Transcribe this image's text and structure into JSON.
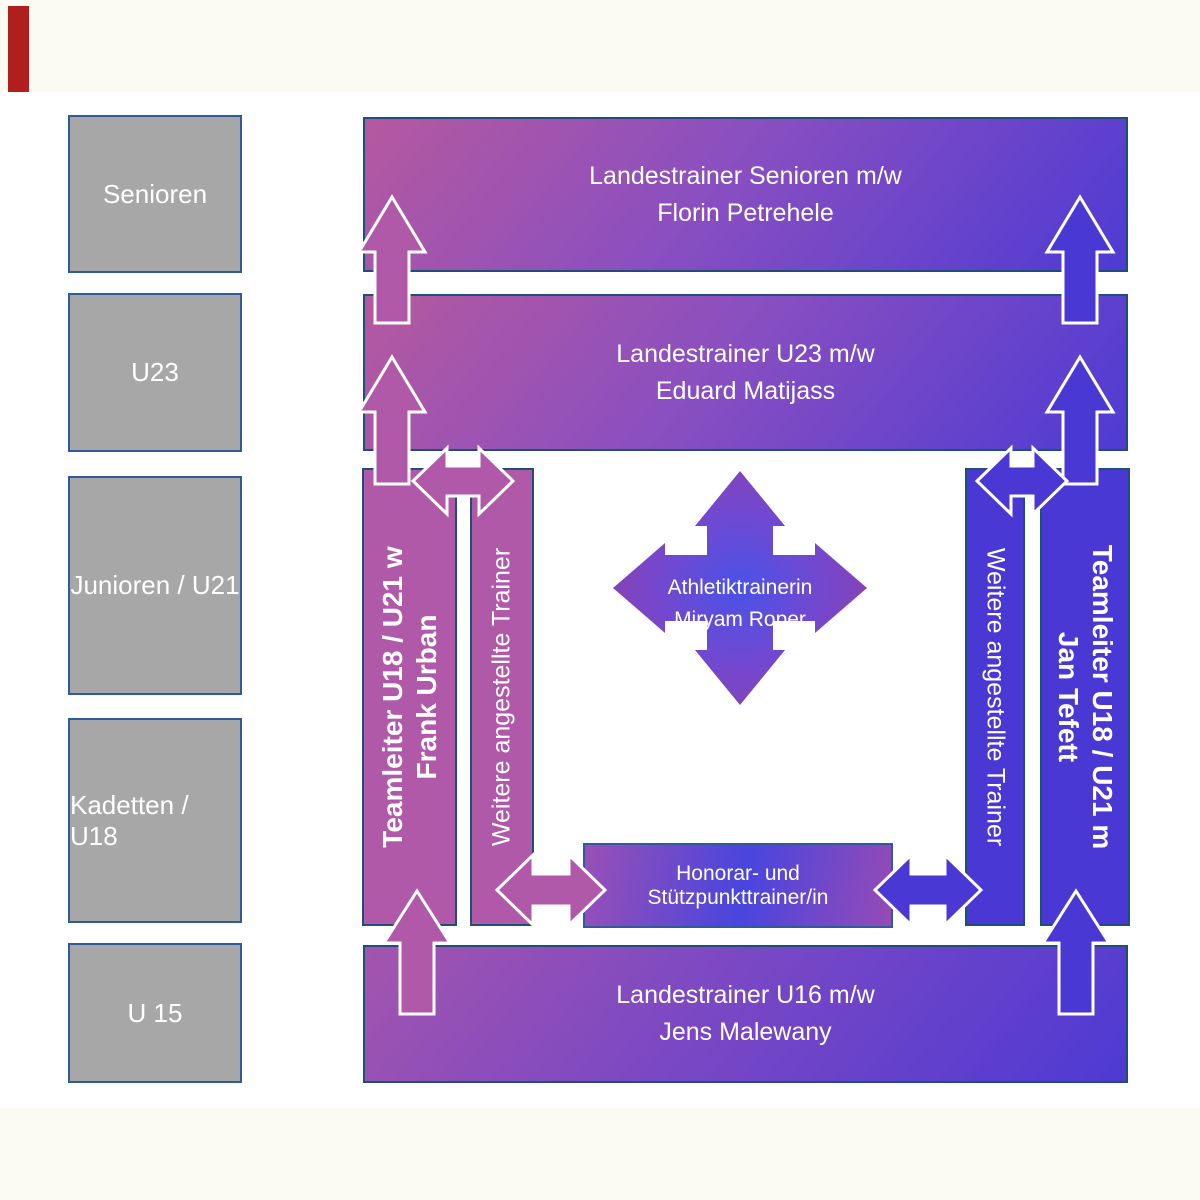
{
  "palette": {
    "pasteboard": "#fbfbf1",
    "slide_background": "#ffffff",
    "gray_box": "#a7a7a7",
    "box_border_navy": "#1f4e79",
    "box_border_blue": "#2f5b9d",
    "pink_solid": "#b159a9",
    "blue_solid": "#4a38d5",
    "gradient_pink_start": "#b5599f",
    "gradient_blue_end": "#4e3bd3",
    "arrow_outline": "#ffffff",
    "red_shape": "#b01e1e",
    "text_color": "#ffffff"
  },
  "sidebar": {
    "boxes": [
      {
        "label": "Senioren"
      },
      {
        "label": "U23"
      },
      {
        "label": "Junioren / U21"
      },
      {
        "label": "Kadetten / U18"
      },
      {
        "label": "U 15"
      }
    ]
  },
  "bars": {
    "senioren": {
      "line1": "Landestrainer Senioren m/w",
      "line2": "Florin Petrehele"
    },
    "u23": {
      "line1": "Landestrainer U23 m/w",
      "line2": "Eduard Matijass"
    },
    "u16": {
      "line1": "Landestrainer U16 m/w",
      "line2": "Jens Malewany"
    },
    "teamleiter_w": {
      "line1": "Teamleiter U18 / U21 w",
      "line2": "Frank Urban"
    },
    "teamleiter_m": {
      "line1": "Teamleiter U18 / U21 m",
      "line2": "Jan Tefett"
    },
    "weitere_left": {
      "label": "Weitere angestellte Trainer"
    },
    "weitere_right": {
      "label": "Weitere angestellte Trainer"
    },
    "honorar": {
      "label": "Honorar- und Stützpunkttrainer/in"
    },
    "athletik": {
      "line1": "Athletiktrainerin",
      "line2": "Miryam Roper"
    }
  }
}
